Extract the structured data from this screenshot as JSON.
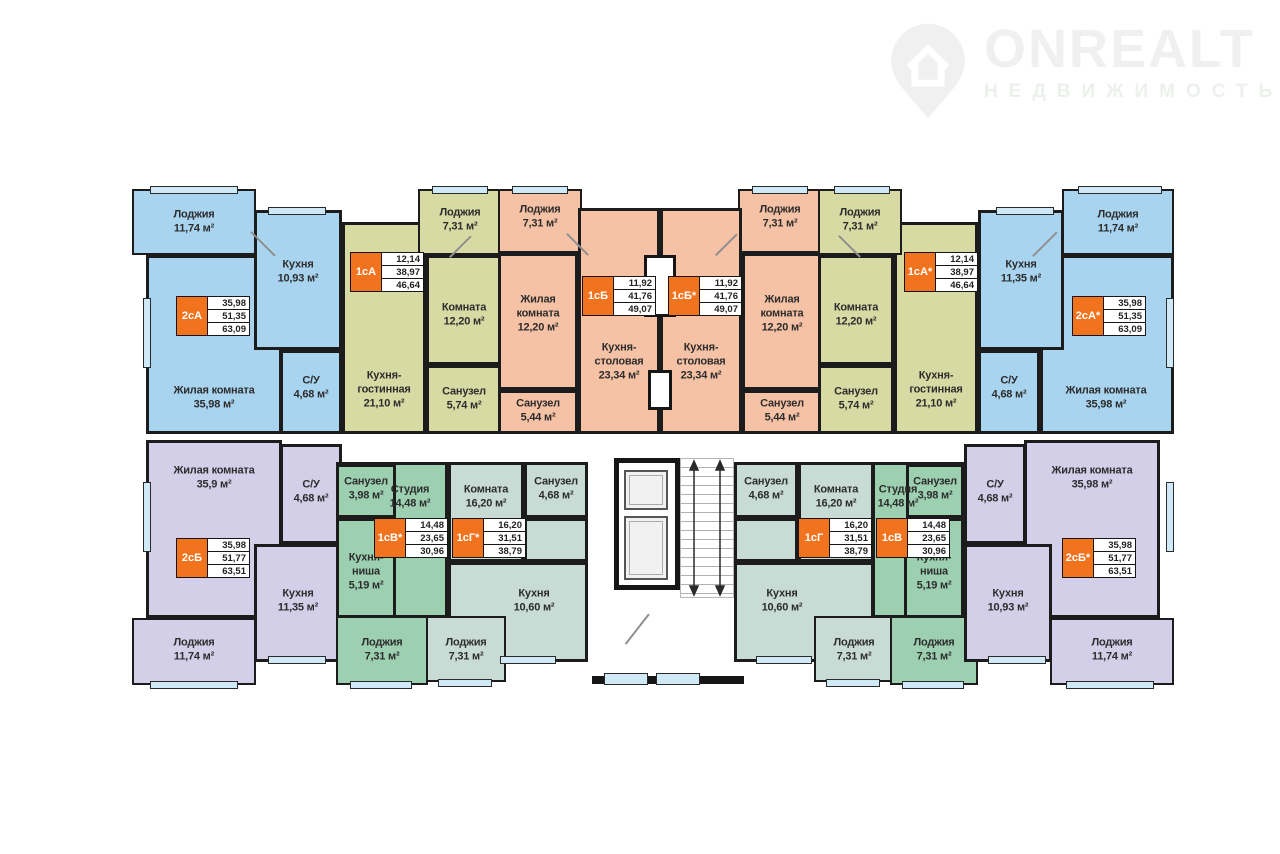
{
  "watermark": {
    "brand": "ONREALT",
    "subtitle": "НЕДВИЖИМОСТЬ"
  },
  "palette": {
    "blue": "#a9d4ef",
    "olive": "#d8daa4",
    "orange": "#f6c2a6",
    "green": "#9dd0b1",
    "teal": "#c8dbd5",
    "purple": "#d4cfe9",
    "accent": "#f2731e",
    "window": "#cfe9f7",
    "wall": "#1c1c1c"
  },
  "apartments": {
    "blue_left": {
      "badge": {
        "label": "2сА",
        "area_rows": [
          "35,98",
          "51,35",
          "63,09"
        ]
      },
      "rooms": {
        "living": {
          "name": "Жилая комната",
          "area": "35,98 м²"
        },
        "kitchen": {
          "name": "Кухня",
          "area": "10,93 м²"
        },
        "su": {
          "name": "С/У",
          "area": "4,68 м²"
        },
        "lodge": {
          "name": "Лоджия",
          "area": "11,74 м²"
        }
      }
    },
    "olive_left": {
      "badge": {
        "label": "1сА",
        "area_rows": [
          "12,14",
          "38,97",
          "46,64"
        ]
      },
      "rooms": {
        "kitchen_living": {
          "name": "Кухня-гостинная",
          "area": "21,10 м²"
        },
        "room": {
          "name": "Комната",
          "area": "12,20 м²"
        },
        "bath": {
          "name": "Санузел",
          "area": "5,74 м²"
        },
        "lodge": {
          "name": "Лоджия",
          "area": "7,31 м²"
        }
      }
    },
    "orange_left": {
      "badge": {
        "label": "1сБ",
        "area_rows": [
          "11,92",
          "41,76",
          "49,07"
        ]
      },
      "rooms": {
        "kitchen_dining": {
          "name": "Кухня-столовая",
          "area": "23,34 м²"
        },
        "living": {
          "name": "Жилая комната",
          "area": "12,20 м²"
        },
        "bath": {
          "name": "Санузел",
          "area": "5,44 м²"
        },
        "lodge": {
          "name": "Лоджия",
          "area": "7,31 м²"
        }
      }
    },
    "orange_right": {
      "badge": {
        "label": "1сБ*",
        "area_rows": [
          "11,92",
          "41,76",
          "49,07"
        ]
      },
      "rooms": {
        "kitchen_dining": {
          "name": "Кухня-столовая",
          "area": "23,34 м²"
        },
        "living": {
          "name": "Жилая комната",
          "area": "12,20 м²"
        },
        "bath": {
          "name": "Санузел",
          "area": "5,44 м²"
        },
        "lodge": {
          "name": "Лоджия",
          "area": "7,31 м²"
        }
      }
    },
    "olive_right": {
      "badge": {
        "label": "1сА*",
        "area_rows": [
          "12,14",
          "38,97",
          "46,64"
        ]
      },
      "rooms": {
        "kitchen_living": {
          "name": "Кухня-гостинная",
          "area": "21,10 м²"
        },
        "room": {
          "name": "Комната",
          "area": "12,20 м²"
        },
        "bath": {
          "name": "Санузел",
          "area": "5,74 м²"
        },
        "lodge": {
          "name": "Лоджия",
          "area": "7,31 м²"
        }
      }
    },
    "blue_right": {
      "badge": {
        "label": "2сА*",
        "area_rows": [
          "35,98",
          "51,35",
          "63,09"
        ]
      },
      "rooms": {
        "living": {
          "name": "Жилая комната",
          "area": "35,98 м²"
        },
        "kitchen": {
          "name": "Кухня",
          "area": "11,35 м²"
        },
        "su": {
          "name": "С/У",
          "area": "4,68 м²"
        },
        "lodge": {
          "name": "Лоджия",
          "area": "11,74 м²"
        }
      }
    },
    "purple_left": {
      "badge": {
        "label": "2сБ",
        "area_rows": [
          "35,98",
          "51,77",
          "63,51"
        ]
      },
      "rooms": {
        "living": {
          "name": "Жилая комната",
          "area": "35,9 м²"
        },
        "su": {
          "name": "С/У",
          "area": "4,68 м²"
        },
        "kitchen": {
          "name": "Кухня",
          "area": "11,35 м²"
        },
        "lodge": {
          "name": "Лоджия",
          "area": "11,74 м²"
        }
      }
    },
    "green_left": {
      "badge": {
        "label": "1сВ*",
        "area_rows": [
          "14,48",
          "23,65",
          "30,96"
        ]
      },
      "rooms": {
        "studio": {
          "name": "Студия",
          "area": "14,48 м²"
        },
        "bath": {
          "name": "Санузел",
          "area": "3,98 м²"
        },
        "niche": {
          "name": "Кухня-ниша",
          "area": "5,19 м²"
        },
        "lodge": {
          "name": "Лоджия",
          "area": "7,31 м²"
        }
      }
    },
    "teal_left": {
      "badge": {
        "label": "1сГ*",
        "area_rows": [
          "16,20",
          "31,51",
          "38,79"
        ]
      },
      "rooms": {
        "room": {
          "name": "Комната",
          "area": "16,20 м²"
        },
        "bath": {
          "name": "Санузел",
          "area": "4,68 м²"
        },
        "kitchen": {
          "name": "Кухня",
          "area": "10,60 м²"
        },
        "lodge": {
          "name": "Лоджия",
          "area": "7,31 м²"
        }
      }
    },
    "teal_right": {
      "badge": {
        "label": "1сГ",
        "area_rows": [
          "16,20",
          "31,51",
          "38,79"
        ]
      },
      "rooms": {
        "room": {
          "name": "Комната",
          "area": "16,20 м²"
        },
        "bath": {
          "name": "Санузел",
          "area": "4,68 м²"
        },
        "kitchen": {
          "name": "Кухня",
          "area": "10,60 м²"
        },
        "lodge": {
          "name": "Лоджия",
          "area": "7,31 м²"
        }
      }
    },
    "green_right": {
      "badge": {
        "label": "1сВ",
        "area_rows": [
          "14,48",
          "23,65",
          "30,96"
        ]
      },
      "rooms": {
        "studio": {
          "name": "Студия",
          "area": "14,48 м²"
        },
        "bath": {
          "name": "Санузел",
          "area": "3,98 м²"
        },
        "niche": {
          "name": "Кухня-ниша",
          "area": "5,19 м²"
        },
        "lodge": {
          "name": "Лоджия",
          "area": "7,31 м²"
        }
      }
    },
    "purple_right": {
      "badge": {
        "label": "2сБ*",
        "area_rows": [
          "35,98",
          "51,77",
          "63,51"
        ]
      },
      "rooms": {
        "living": {
          "name": "Жилая комната",
          "area": "35,98 м²"
        },
        "su": {
          "name": "С/У",
          "area": "4,68 м²"
        },
        "kitchen": {
          "name": "Кухня",
          "area": "10,93 м²"
        },
        "lodge": {
          "name": "Лоджия",
          "area": "11,74 м²"
        }
      }
    }
  }
}
